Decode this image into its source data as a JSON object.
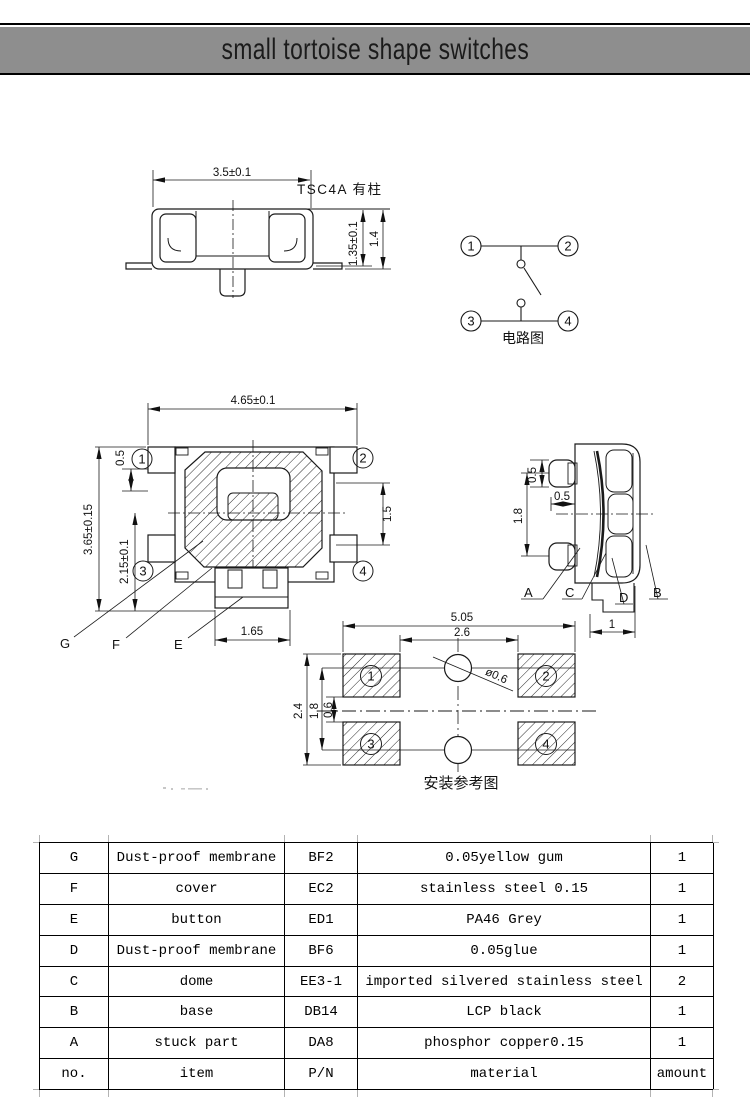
{
  "title_bar": {
    "title": "small tortoise shape switches"
  },
  "side_view": {
    "model_label": "TSC4A 有柱",
    "dim_width": "3.5±0.1",
    "dim_body_height": "1.35±0.1",
    "dim_total_height": "1.4"
  },
  "circuit_diagram": {
    "caption": "电路图",
    "terminals": [
      "1",
      "2",
      "3",
      "4"
    ]
  },
  "top_view": {
    "dim_width": "4.65±0.1",
    "dim_height": "3.65±0.15",
    "dim_lower_height": "2.15±0.1",
    "dim_terminal_offset": "0.5",
    "dim_button_height": "1.5",
    "dim_stem_width": "1.65",
    "terminals": [
      "1",
      "2",
      "3",
      "4"
    ],
    "part_labels": {
      "g": "G",
      "f": "F",
      "e": "E"
    }
  },
  "right_view": {
    "dim_terminal_height": "0.5",
    "dim_terminal_protrusion": "0.5",
    "dim_pitch": "1.8",
    "dim_foot_width": "1",
    "part_labels": {
      "a": "A",
      "c": "C",
      "d": "D",
      "b": "B"
    }
  },
  "pcb_layout": {
    "caption": "安装参考图",
    "dim_total_width": "5.05",
    "dim_inner_width": "2.6",
    "dim_total_height": "2.4",
    "dim_hole_pitch": "1.8",
    "dim_pad_gap": "0.6",
    "hole_diameter": "ø0.6",
    "pads": [
      "1",
      "2",
      "3",
      "4"
    ]
  },
  "table": {
    "columns": [
      "no.",
      "item",
      "P/N",
      "material",
      "amount"
    ],
    "rows": [
      [
        "G",
        "Dust-proof membrane",
        "BF2",
        "0.05yellow gum",
        "1"
      ],
      [
        "F",
        "cover",
        "EC2",
        "stainless steel 0.15",
        "1"
      ],
      [
        "E",
        "button",
        "ED1",
        "PA46 Grey",
        "1"
      ],
      [
        "D",
        "Dust-proof membrane",
        "BF6",
        "0.05glue",
        "1"
      ],
      [
        "C",
        "dome",
        "EE3-1",
        "imported silvered stainless steel",
        "2"
      ],
      [
        "B",
        "base",
        "DB14",
        "LCP black",
        "1"
      ],
      [
        "A",
        "stuck part",
        "DA8",
        "phosphor copper0.15",
        "1"
      ]
    ]
  }
}
